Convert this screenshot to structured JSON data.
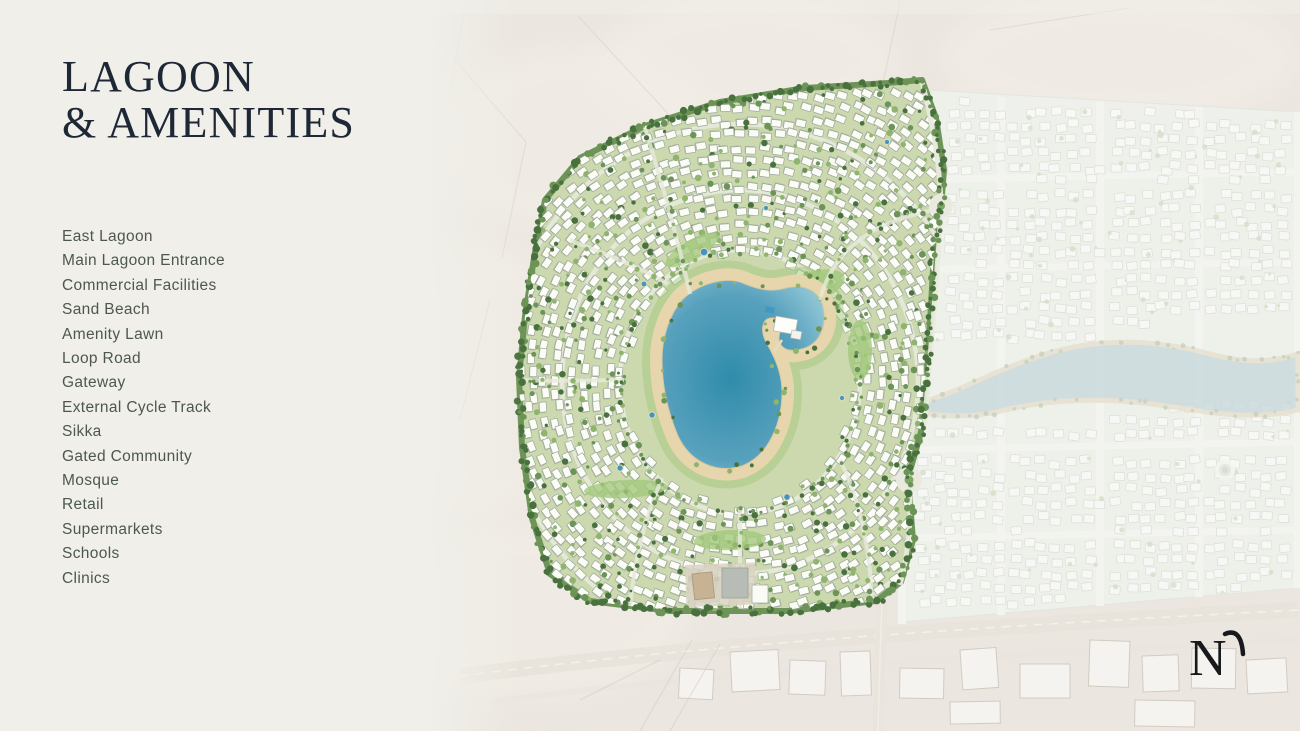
{
  "slide": {
    "title_line1": "LAGOON",
    "title_line2": "& AMENITIES"
  },
  "legend": {
    "items": [
      "East Lagoon",
      "Main Lagoon Entrance",
      "Commercial Facilities",
      "Sand Beach",
      "Amenity Lawn",
      "Loop Road",
      "Gateway",
      "External Cycle Track",
      "Sikka",
      "Gated Community",
      "Mosque",
      "Retail",
      "Supermarkets",
      "Schools",
      "Clinics"
    ]
  },
  "logo": {
    "letter": "N"
  },
  "map": {
    "palette": {
      "panel_bg": "#f0efe9",
      "title_text": "#1e2735",
      "legend_text": "#4d5751",
      "desert": "#ebe6df",
      "desert_line": "#d7d0c5",
      "vivid_base": "#ccd9ae",
      "vivid_edge": "#6f9459",
      "lawn": "#a3c87c",
      "tree_dark": "#48713e",
      "tree_mid": "#6d9457",
      "tree_light": "#8fb46d",
      "house_fill": "#fbfcf6",
      "house_stroke": "#9ba69a",
      "house_shadow": "#8e988e",
      "road": "#e7e9dc",
      "sand": "#e9d7ae",
      "water_deep": "#2f8cab",
      "water_mid": "#58a1bd",
      "water_light": "#8ec5d6",
      "pool": "#3f96c4",
      "faded_base": "#eff1ec",
      "faded_house": "#f9faf7",
      "faded_stroke": "#dce1d8",
      "faded_road": "#f4f5f1",
      "faded_green": "#d3dfc9",
      "faded_water": "#c6d9dd",
      "faded_sand": "#e6dfcd",
      "sketch_line": "#d2cbc1",
      "logo_color": "#17191c"
    }
  }
}
